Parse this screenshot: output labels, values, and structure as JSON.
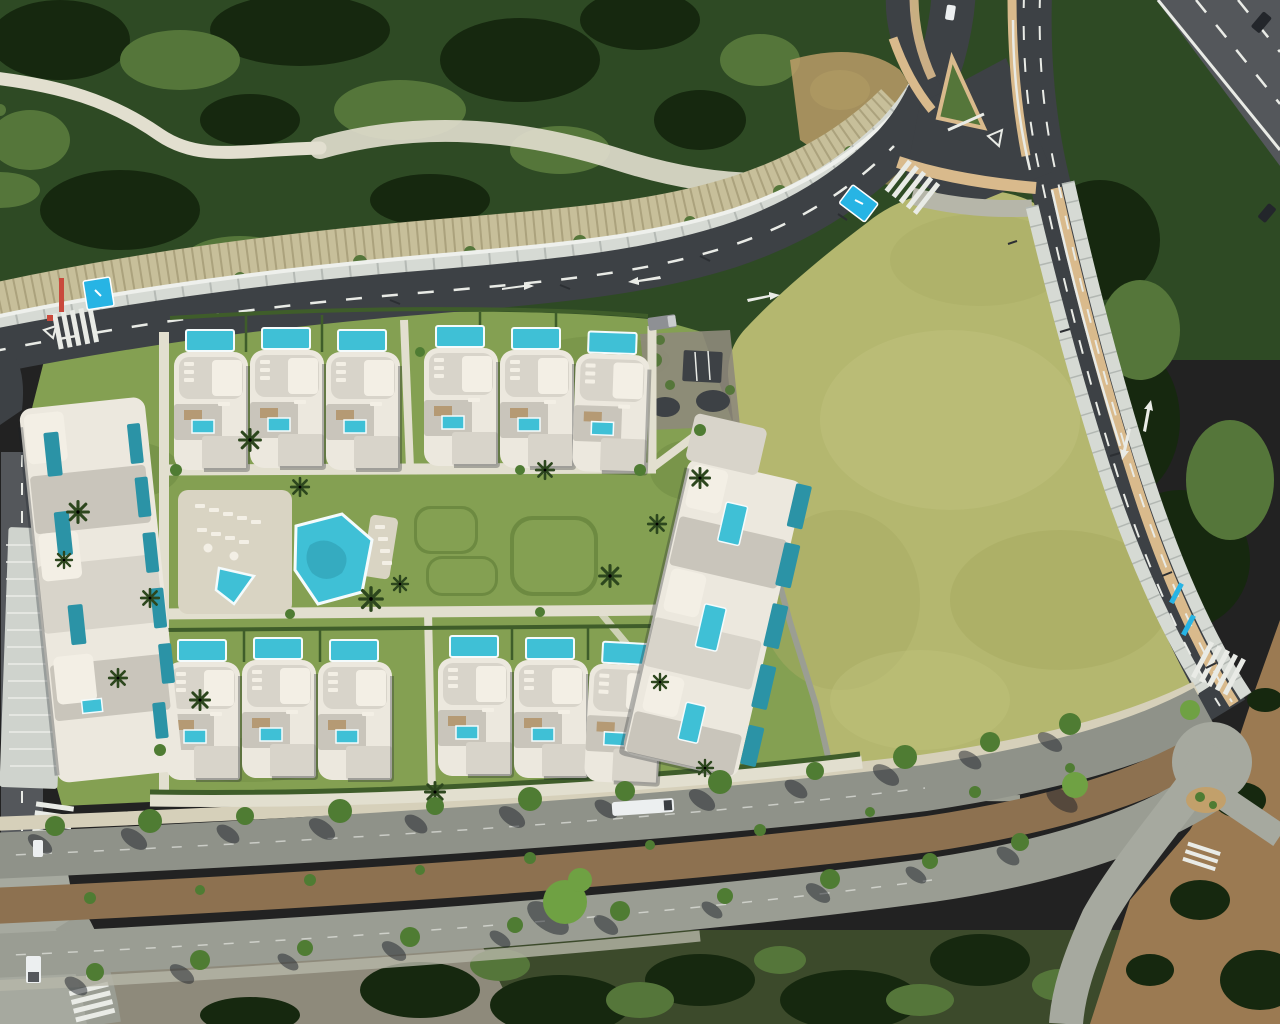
{
  "scene": {
    "title": "Aerial render of a Mediterranean villa development beside a large green field",
    "road_marking": "30",
    "colors": {
      "forest": "#2e4a24",
      "forestDark": "#16280f",
      "forestLight": "#55763a",
      "forestPale": "#6f9147",
      "pathPale": "#e2dfcf",
      "riprap": "#c7bf9a",
      "rockDark": "#8f865f",
      "roadDark": "#3d4145",
      "roadMid": "#54575b",
      "boulevardUpper": "#8f9289",
      "boulevardLower": "#9a9d93",
      "junctionGrey": "#a6a99f",
      "laneWhite": "#e9ebe6",
      "wallLight": "#d6dad4",
      "wallJoint": "#9aa09b",
      "wallThin": "#c2c6c0",
      "sidewalkTan": "#d9ba8c",
      "pavingGrey": "#b6b6a9",
      "promenade": "#d6d0ba",
      "dirt": "#9b7a52",
      "dirtLight": "#c2a06b",
      "field": "#b4b76f",
      "fieldShade": "#a8ac63",
      "fieldLight": "#c0c27d",
      "curb": "#9b9e93",
      "lawn": "#84a052",
      "lawnDark": "#6d8a41",
      "hedge": "#3f5d2a",
      "palm": "#2d471e",
      "treeGreen": "#4f7c33",
      "treeLight": "#6fa143",
      "shadow": "#1c2128",
      "pool": "#3fc0d6",
      "poolDeep": "#2b93a6",
      "poolRim": "#f4fbfc",
      "building": "#ece8de",
      "buildingShade": "#d8d4ca",
      "roof": "#c9c5bb",
      "terrace": "#f3efe5",
      "deckWood": "#b59a74",
      "deckPale": "#d9d4c3",
      "median": "#8d7150",
      "scrub": "#3c4a2b",
      "rockyGround": "#8e8a7b",
      "parkingBlue": "#27b4e4",
      "redPole": "#c9493c",
      "vehicleWhite": "#eceff0",
      "vehicleGrey": "#8e9094",
      "vehicleDark": "#23262b",
      "structRibbed": "#cfd3cd",
      "blueDoor": "#2f6fd8"
    }
  }
}
